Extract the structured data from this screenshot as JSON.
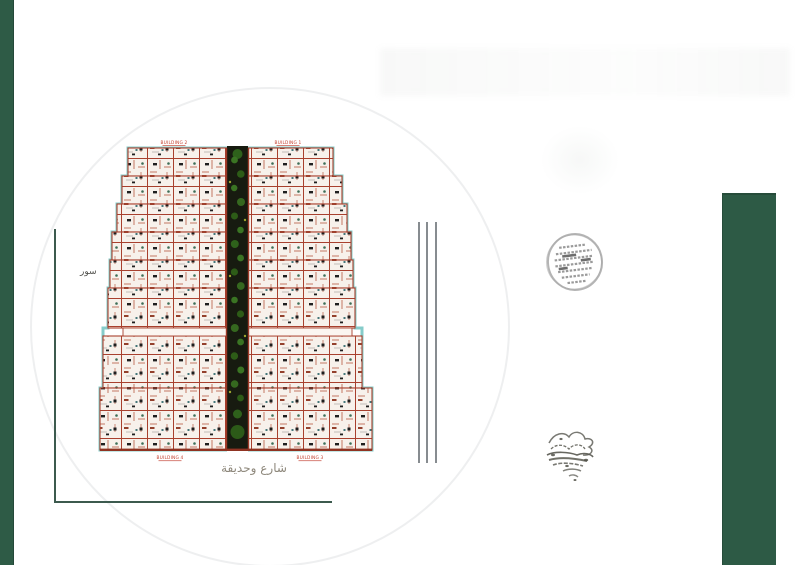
{
  "labels": {
    "building_top_left": "BUILDING 2",
    "building_top_right": "BUILDING 1",
    "building_bottom_left": "BUILDING 4",
    "building_bottom_right": "BUILDING 3",
    "street": "شارع وحديقة",
    "side": "سور"
  },
  "icons": {
    "round_stamp": "official-round-stamp",
    "signature_stamp": "handwritten-signature-stamp"
  },
  "colors": {
    "left_bar_green": "#2e5b46",
    "right_panel_green": "#2d5a45",
    "wall_red": "#a8402e",
    "deep_red": "#8f3322",
    "outline_cyan": "#86ccca",
    "road_dark": "#171b10",
    "tree_green": "#3a7423",
    "label_red": "#c23b2a",
    "street_text_gray": "#8e887c",
    "frame_line": "#3c5a4e",
    "dimension_line_gray": "#878c90"
  }
}
